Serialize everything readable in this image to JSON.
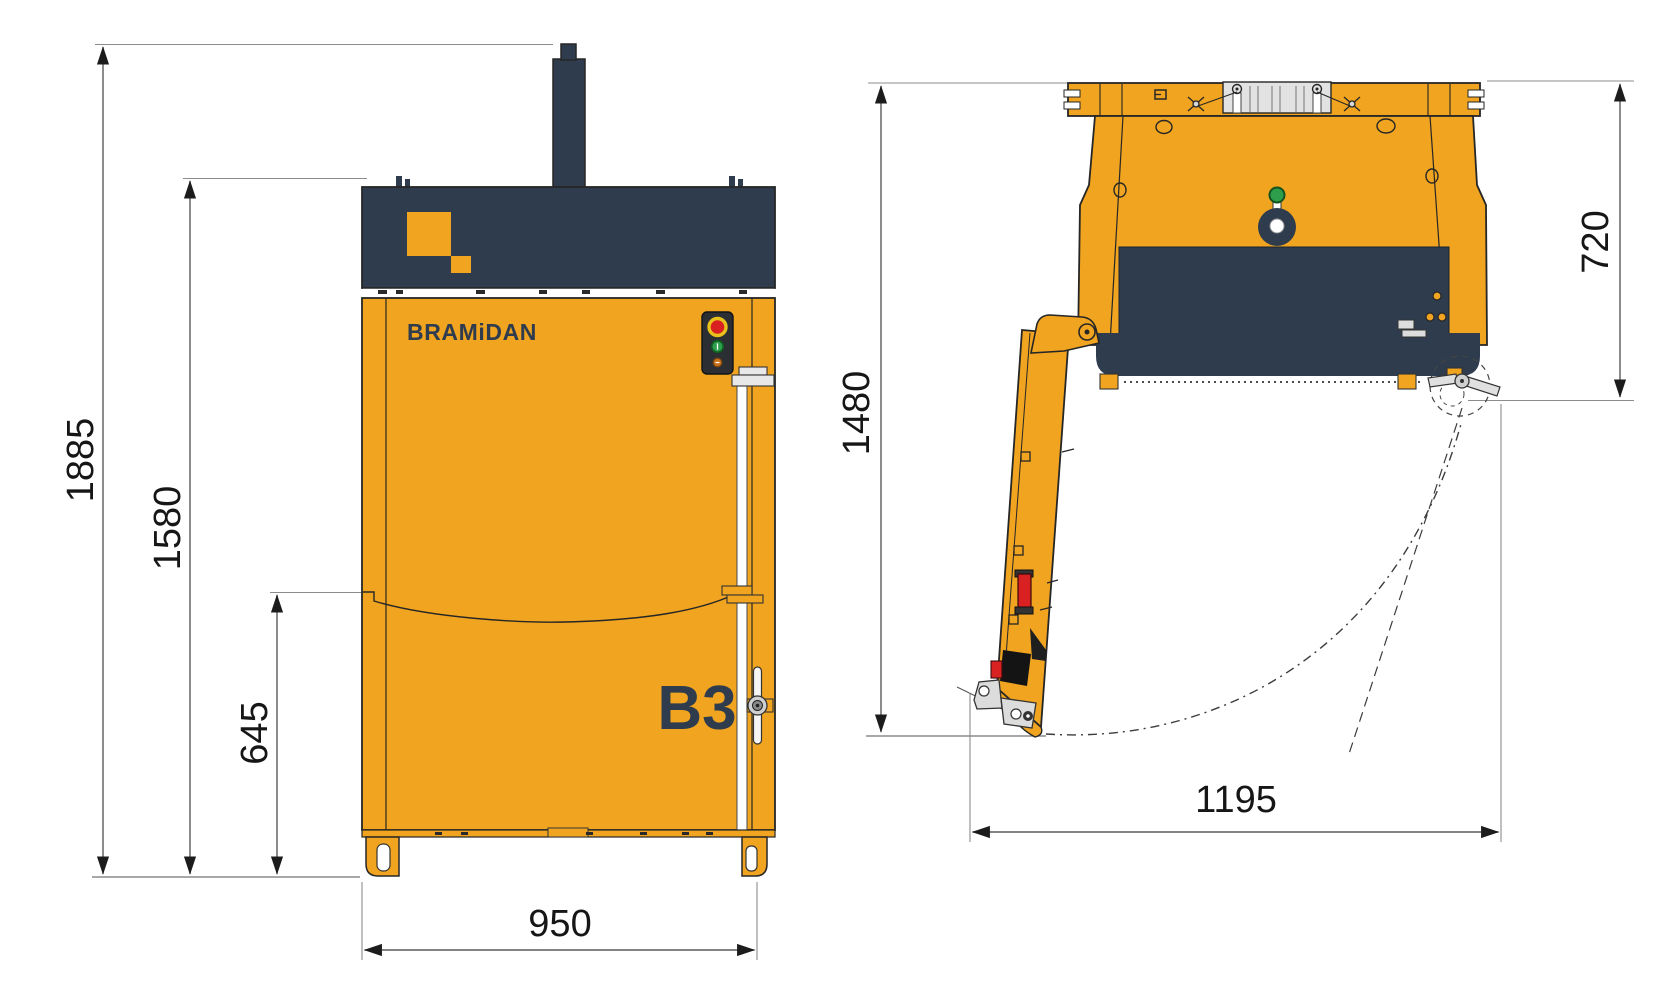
{
  "title": "Baler technical dimension drawing, front and side views",
  "brand": "BRAMiDAN",
  "model": "B3",
  "colors": {
    "body": "#F0A41F",
    "dark": "#2E3C4E",
    "outline": "#262626",
    "dim": "#5a5a5a",
    "red": "#D92121",
    "green": "#2F9E4C",
    "amber": "#C9731E",
    "metal": "#DCDCDC"
  },
  "front_view": {
    "name": "front-view",
    "dimensions": [
      {
        "id": "height-total",
        "value": "1885"
      },
      {
        "id": "height-body",
        "value": "1580"
      },
      {
        "id": "height-lower-door",
        "value": "645"
      },
      {
        "id": "width",
        "value": "950"
      }
    ]
  },
  "side_view": {
    "name": "side-view-door-open",
    "dimensions": [
      {
        "id": "height-door-open",
        "value": "1480"
      },
      {
        "id": "depth-top",
        "value": "720"
      },
      {
        "id": "depth-door-open",
        "value": "1195"
      }
    ]
  }
}
